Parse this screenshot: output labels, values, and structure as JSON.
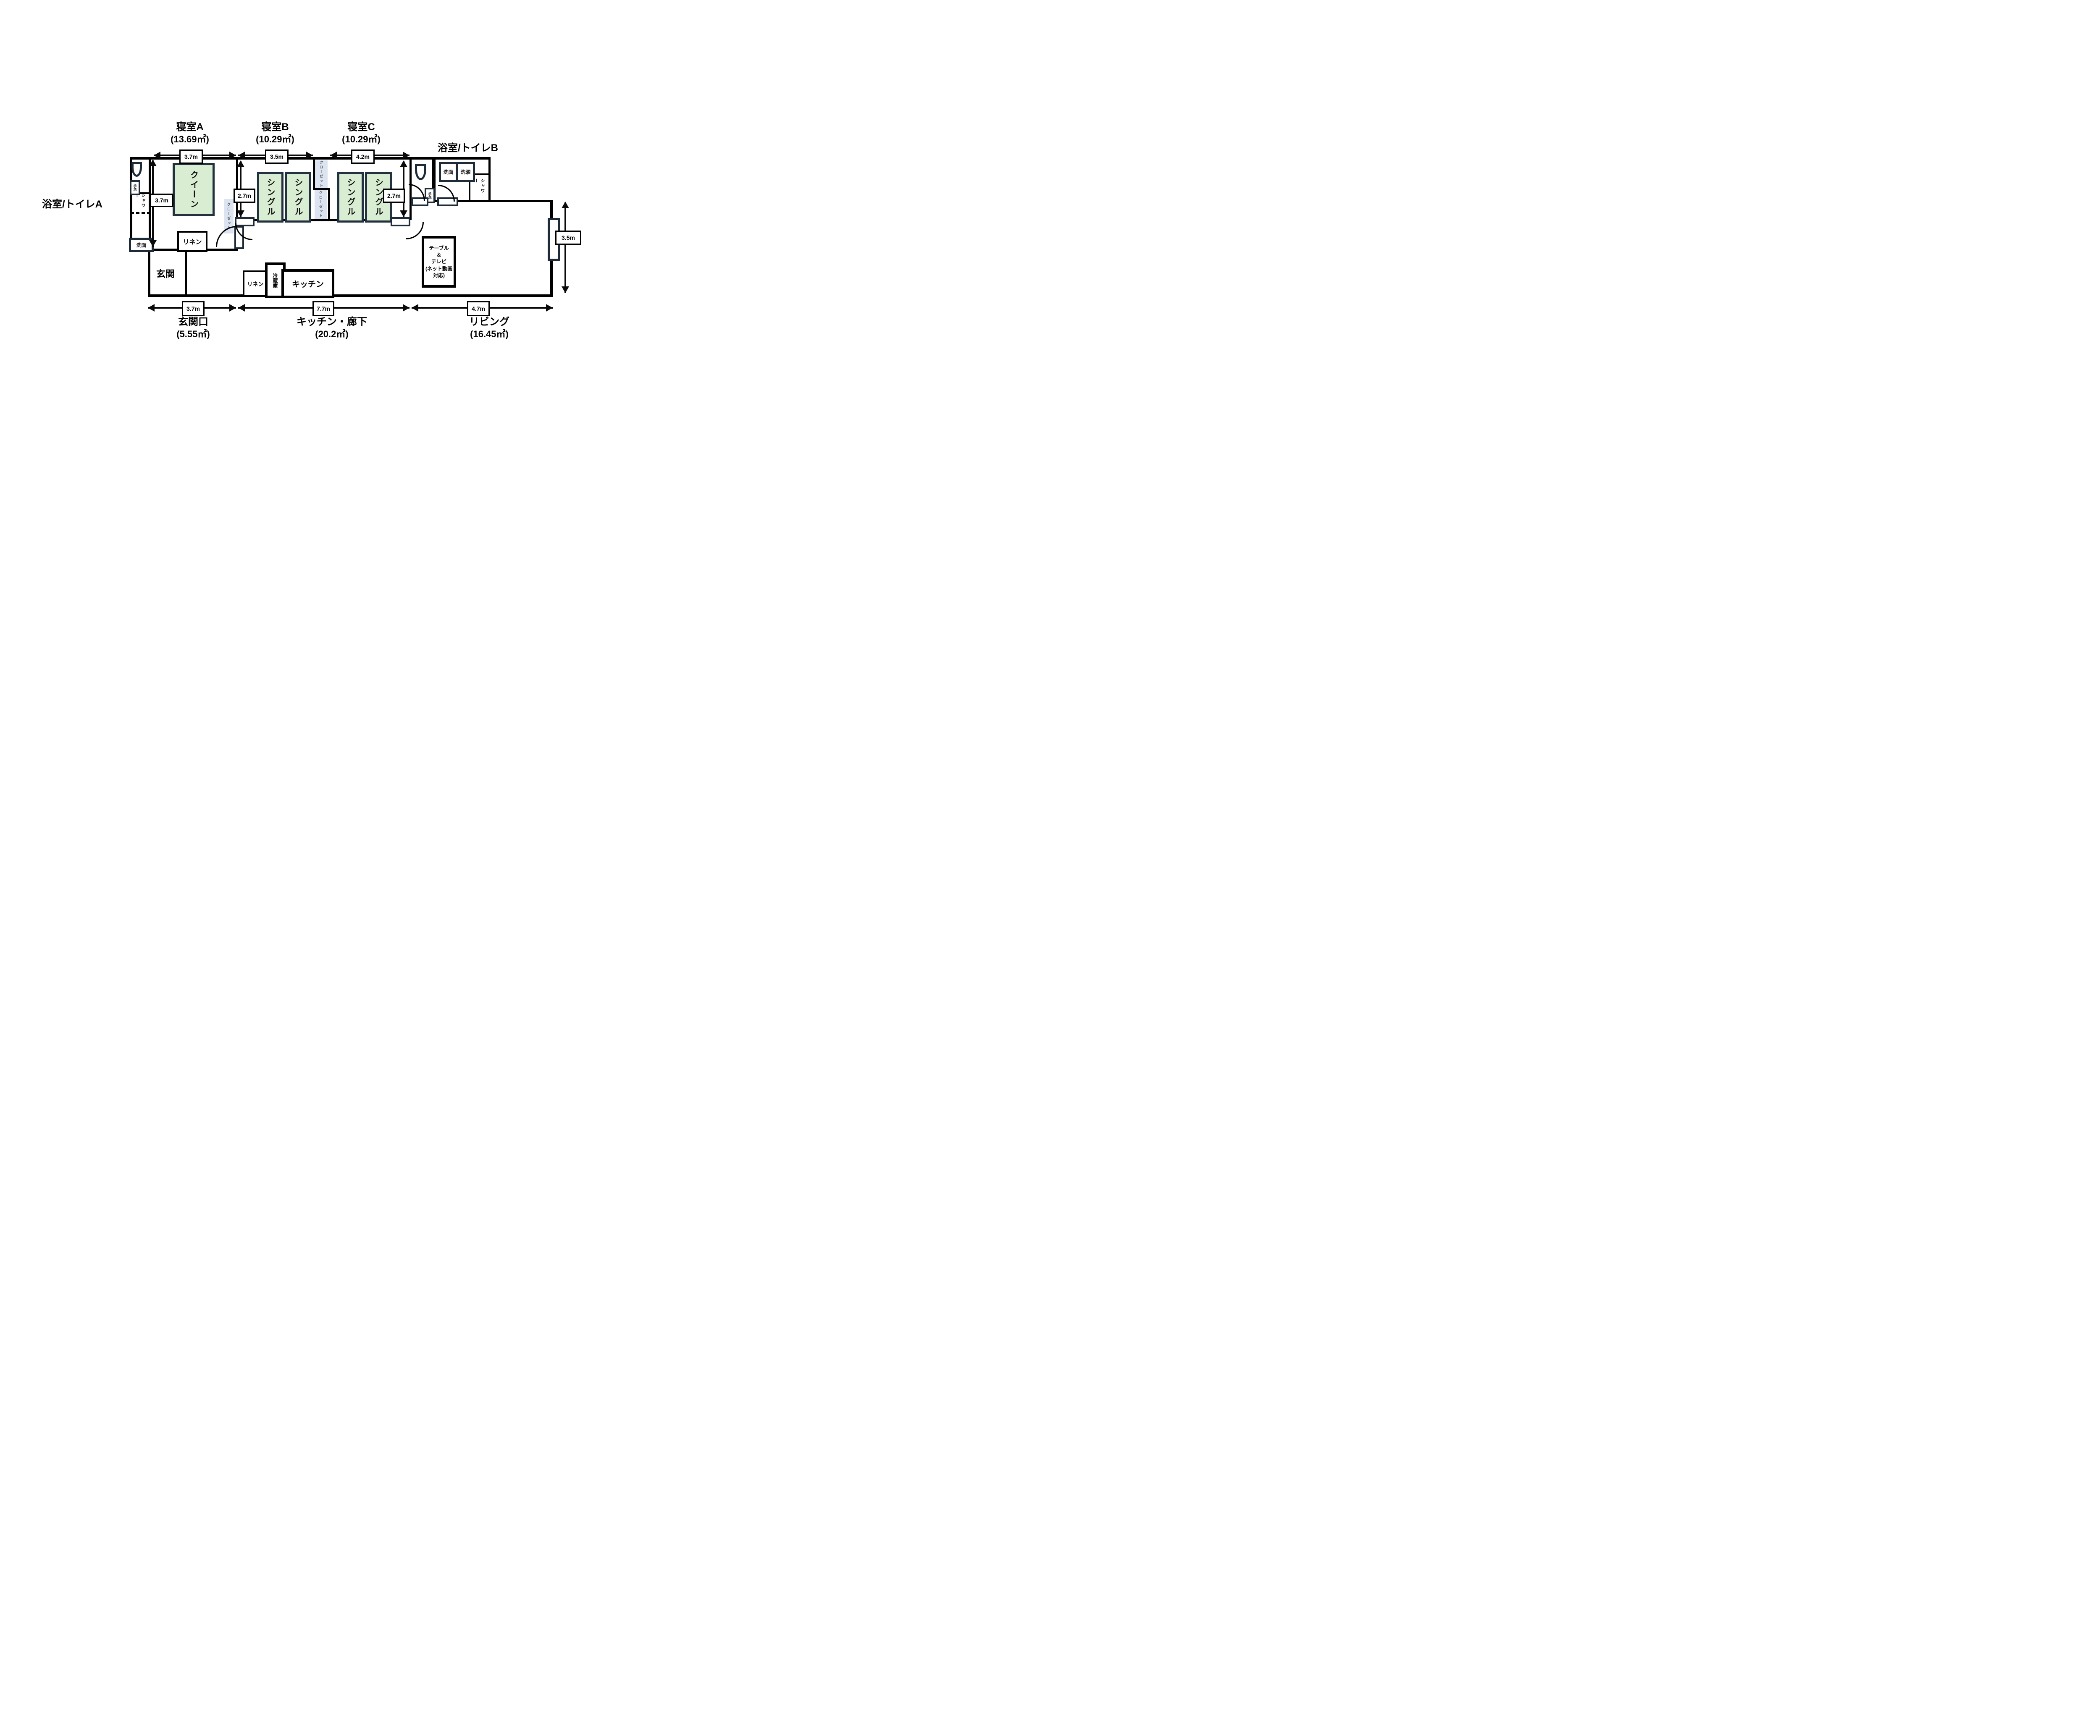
{
  "plan": {
    "rooms": {
      "bedroom_a": {
        "name": "寝室A",
        "area": "(13.69㎡)"
      },
      "bedroom_b": {
        "name": "寝室B",
        "area": "(10.29㎡)"
      },
      "bedroom_c": {
        "name": "寝室C",
        "area": "(10.29㎡)"
      },
      "bathroom_a": {
        "name": "浴室/トイレA"
      },
      "bathroom_b": {
        "name": "浴室/トイレB"
      },
      "entrance": {
        "name": "玄関"
      },
      "entrance_area": {
        "name": "玄関口",
        "area": "(5.55㎡)"
      },
      "kitchen_hallway": {
        "name": "キッチン・廊下",
        "area": "(20.2㎡)"
      },
      "living": {
        "name": "リビング",
        "area": "(16.45㎡)"
      }
    },
    "furniture": {
      "queen_bed": "クイーン",
      "single_bed": "シングル",
      "closet": "クローゼット",
      "linen": "リネン",
      "fridge": "冷蔵庫",
      "kitchen_counter": "キッチン",
      "washbasin": "洗面",
      "laundry": "洗濯",
      "hand_wash": "手洗",
      "shower": "シャワー",
      "table_tv_lines": [
        "テーブル",
        "＆",
        "テレビ",
        "(ネット動画",
        "対応)"
      ]
    },
    "dimensions": {
      "top_a": "3.7m",
      "top_b": "3.5m",
      "top_c": "4.2m",
      "side_a": "3.7m",
      "depth_b": "2.7m",
      "depth_c": "2.7m",
      "side_living": "3.5m",
      "bottom_a": "3.7m",
      "bottom_b": "7.7m",
      "bottom_c": "4.7m"
    },
    "colors": {
      "wall": "#000000",
      "fixture_navy": "#1d2b38",
      "bed_fill": "#d8edd2",
      "closet_fill": "#dde4f1"
    }
  }
}
